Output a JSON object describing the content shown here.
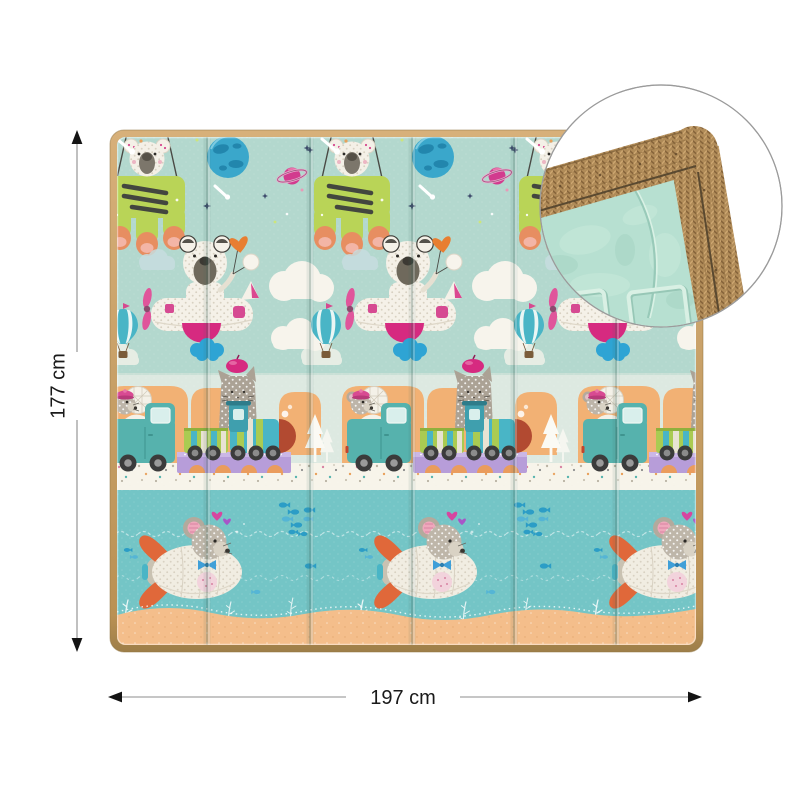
{
  "image": {
    "type": "product-dimension-photo",
    "background": "#ffffff"
  },
  "dimensions": {
    "height_label": "177 cm",
    "width_label": "197 cm",
    "unit": "cm"
  },
  "mat": {
    "panels": 6,
    "border_color": "#c7a067",
    "bands": [
      {
        "name": "space-sky",
        "color": "#b3d8ce",
        "motifs": [
          "koala-in-green-rover",
          "blue-planet",
          "saturn",
          "stars",
          "comets"
        ]
      },
      {
        "name": "cloud-sky",
        "color": "#b3d8ce",
        "motifs": [
          "bear-on-airplane",
          "heart-balloon",
          "hot-air-balloon",
          "clouds"
        ]
      },
      {
        "name": "road",
        "color": "#dde9e1",
        "motifs": [
          "mouse-truck",
          "cat-on-train",
          "tunnel-arches",
          "white-trees",
          "confetti-road"
        ]
      },
      {
        "name": "sea",
        "color": "#74c5c6",
        "motifs": [
          "mouse-submarine",
          "fish-school",
          "seaweed",
          "dotted-waves"
        ]
      },
      {
        "name": "sand",
        "color": "#f4be8b",
        "motifs": []
      }
    ]
  },
  "inset": {
    "shape": "circle",
    "border_color": "#9b9b9b",
    "contents": [
      "woven-edge-texture",
      "embossed-foam-surface"
    ],
    "foam_color": "#b7e0d1",
    "weave_color": "#b08b58"
  },
  "annotation_style": {
    "line_color": "#8c8c8c",
    "arrow_color": "#141414",
    "text_color": "#1a1a1a"
  }
}
